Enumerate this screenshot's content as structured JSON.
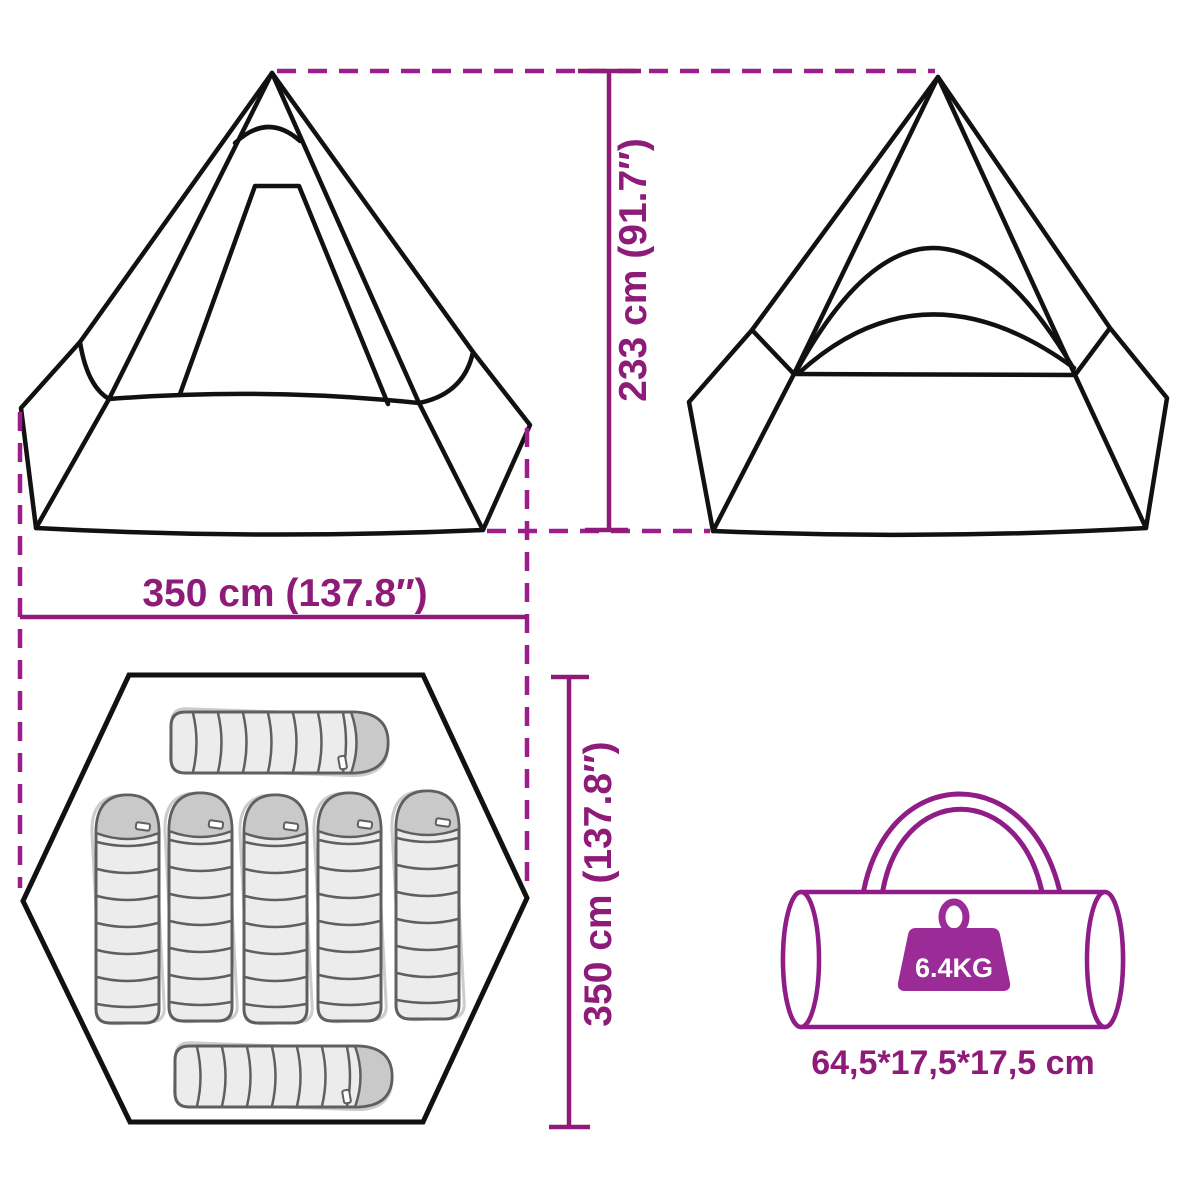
{
  "title": "Teepee tent dimension diagram",
  "labels": {
    "height": "233 cm (91.7″)",
    "width": "350 cm (137.8″)",
    "depth": "350 cm (137.8″)",
    "bag_size": "64,5*17,5*17,5 cm",
    "weight": "6.4KG"
  },
  "icons": {
    "weight_icon": "kettlebell-weight-icon",
    "carry_bag_icon": "duffel-carry-bag-icon",
    "sleeping_bag_icon": "sleeping-bag-icon"
  },
  "views": {
    "front": "tent-front-view",
    "back": "tent-back-view",
    "floor": "floor-plan-top-view",
    "packed": "packed-carry-bag-view"
  },
  "floor_plan": {
    "sleeping_bag_count": 7,
    "vertical_bags": 5,
    "horizontal_bags": 2
  },
  "colors": {
    "dimension": "#8d1b77",
    "dash": "#9c1e8c",
    "tent_line": "#111111",
    "bag_outline": "#8f1d88",
    "weight_fill": "#9b2b96",
    "weight_text": "#ffffff",
    "sleeping_bag_fill": "#ececec",
    "sleeping_bag_hood": "#c9c9c9",
    "sleeping_bag_line": "#5f5f5f",
    "sleeping_bag_ghost": "#cccccc"
  }
}
